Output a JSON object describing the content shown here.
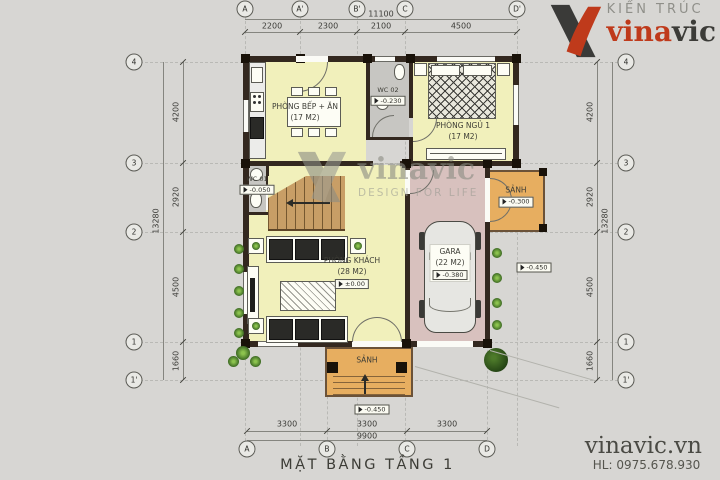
{
  "branding": {
    "firm_line1": "KIẾN TRÚC",
    "brand_red": "vina",
    "brand_dark": "vic",
    "website": "vinavic.vn",
    "hotline": "HL: 0975.678.930"
  },
  "watermark": {
    "brand": "vinavic",
    "tagline": "DESIGN FOR LIFE"
  },
  "plan": {
    "title": "MẶT BẰNG TẦNG 1"
  },
  "grid": {
    "top_bubbles": [
      "A",
      "A'",
      "B'",
      "C",
      "D'"
    ],
    "bottom_bubbles": [
      "A",
      "B",
      "C",
      "D"
    ],
    "left_bubbles": [
      "4",
      "3",
      "2",
      "1",
      "1'"
    ],
    "right_bubbles": [
      "4",
      "3",
      "2",
      "1",
      "1'"
    ],
    "top_total": "11100",
    "top_segments": [
      "2200",
      "2300",
      "2100",
      "4500"
    ],
    "bottom_total": "9900",
    "bottom_segments": [
      "3300",
      "3300",
      "3300"
    ],
    "side_total": "13280",
    "side_segments": [
      "4200",
      "2920",
      "4500",
      "1660"
    ]
  },
  "rooms": {
    "kitchen": {
      "name": "PHÒNG BẾP + ĂN",
      "area": "(17 M2)"
    },
    "wc2": {
      "name": "WC 02",
      "level": "-0.230"
    },
    "bedroom": {
      "name": "PHÒNG NGỦ 1",
      "area": "(17 M2)"
    },
    "wc1": {
      "name": "WC 01",
      "level": "-0.050"
    },
    "living": {
      "name": "PHÒNG KHÁCH",
      "area": "(28 M2)",
      "level": "±0.00"
    },
    "garage": {
      "name": "GARA",
      "area": "(22 M2)",
      "level": "-0.380"
    },
    "side_porch": {
      "name": "SẢNH",
      "level": "-0.300"
    },
    "front_porch": {
      "name": "SẢNH",
      "level": "-0.450"
    }
  },
  "site_levels": {
    "yard_right": "-0.450"
  },
  "colors": {
    "brand_red": "#bf3a1b",
    "room_yellow": "#f1f0bb",
    "garage_pink": "#d8c1be",
    "porch_orange": "#e7ae60",
    "wall_dark": "#33281f",
    "background": "#d7d6d3"
  }
}
